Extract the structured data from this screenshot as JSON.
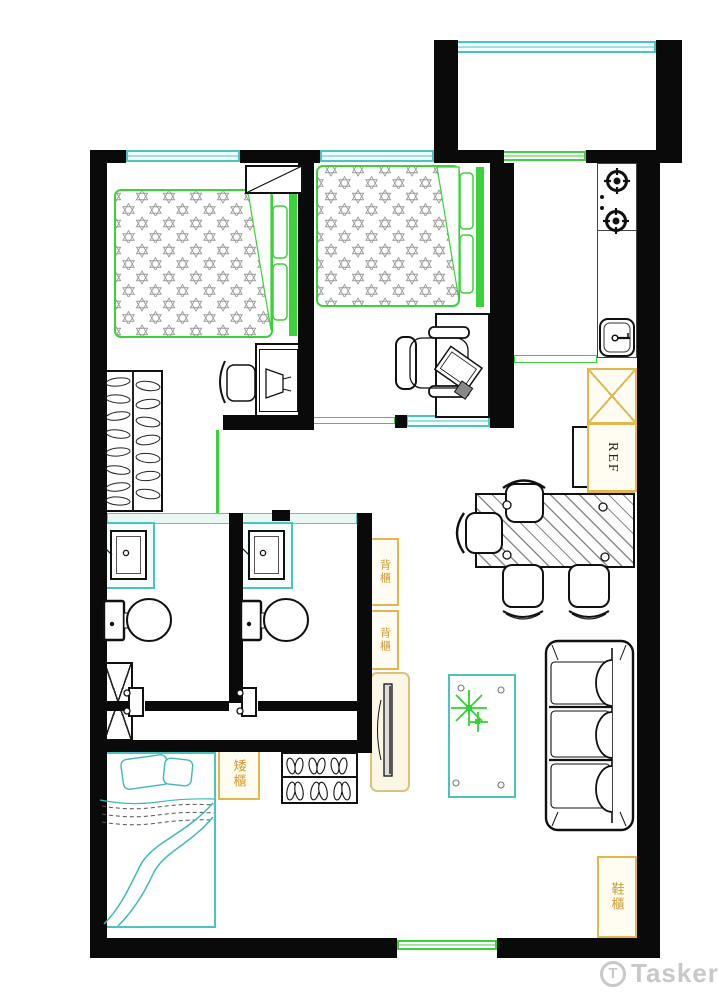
{
  "page": {
    "type": "apartment-floor-plan",
    "background": "#ffffff"
  },
  "labels": {
    "refrigerator": "REF",
    "back_cabinet_upper": "背櫃",
    "back_cabinet_lower": "背櫃",
    "low_cabinet": "矮櫃",
    "shoe_cabinet": "鞋櫃"
  },
  "watermark": {
    "brand": "Tasker",
    "logo_letter": "T"
  },
  "colors": {
    "wall_black": "#0a0a0a",
    "partition_green": "#3bd23b",
    "window_teal": "#4cc3c3",
    "cabinet_yellow_border": "#e3b64e",
    "cabinet_label_orange": "#cf9a30",
    "hatch_gray": "#8a8a8a",
    "watermark_gray": "#c8c8c8"
  },
  "symbols": [
    "double-bed",
    "single-bed",
    "nightstand",
    "wardrobe",
    "desk",
    "office-chair",
    "laptop",
    "gas-stove",
    "kitchen-sink",
    "refrigerator",
    "dining-table",
    "dining-chair",
    "sofa-three-seat",
    "coffee-table",
    "potted-plant",
    "tv",
    "tv-cabinet",
    "wash-basin",
    "toilet",
    "bathroom-door",
    "duct-shaft",
    "slipper-cabinet",
    "balcony-window",
    "entry-door"
  ]
}
